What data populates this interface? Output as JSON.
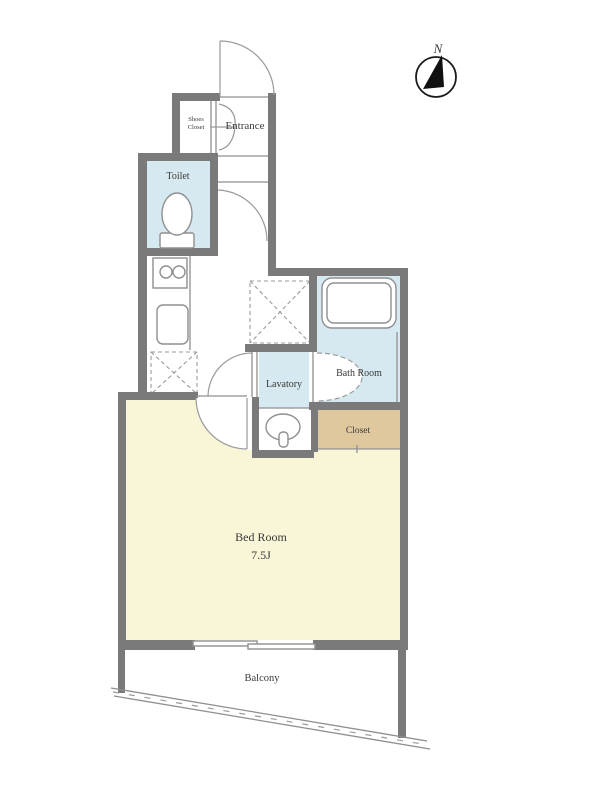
{
  "plan": {
    "title": "apartment-floor-plan",
    "compass": {
      "label": "N"
    },
    "rooms": {
      "entrance": {
        "label": "Entrance"
      },
      "shoes_closet": {
        "line1": "Shoes",
        "line2": "Closet"
      },
      "toilet": {
        "label": "Toilet"
      },
      "lavatory": {
        "label": "Lavatory"
      },
      "bath": {
        "label": "Bath Room"
      },
      "closet": {
        "label": "Closet"
      },
      "bedroom": {
        "label": "Bed Room",
        "size": "7.5J"
      },
      "balcony": {
        "label": "Balcony"
      }
    },
    "colors": {
      "wall": "#7a7a7a",
      "wet_area": "#d6e9f0",
      "bedroom": "#f9f6d8",
      "closet": "#dfc89e",
      "line": "#8f8f8f",
      "text": "#3a3a3a"
    }
  }
}
